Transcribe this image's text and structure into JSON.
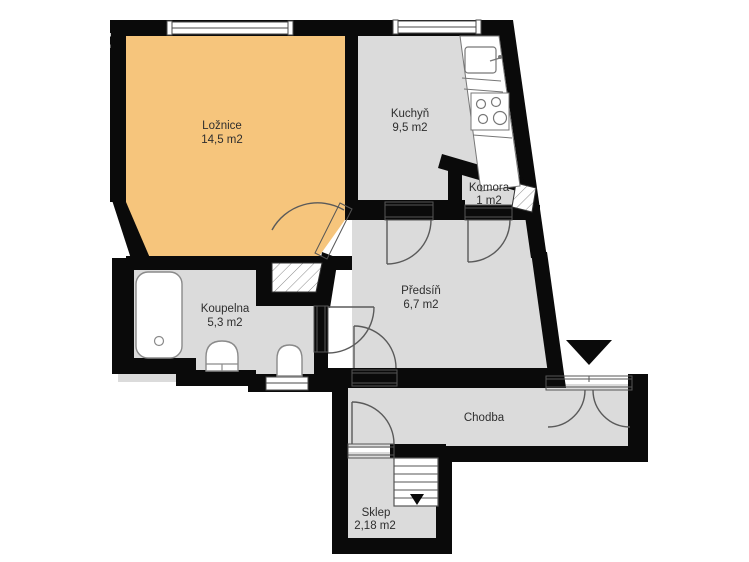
{
  "floorplan": {
    "rooms": [
      {
        "id": "loznice",
        "name": "Ložnice",
        "area": "14,5 m2"
      },
      {
        "id": "kuchyn",
        "name": "Kuchyň",
        "area": "9,5 m2"
      },
      {
        "id": "komora",
        "name": "Komora",
        "area": "1 m2"
      },
      {
        "id": "predsin",
        "name": "Předsíň",
        "area": "6,7 m2"
      },
      {
        "id": "koupelna",
        "name": "Koupelna",
        "area": "5,3 m2"
      },
      {
        "id": "chodba",
        "name": "Chodba",
        "area": ""
      },
      {
        "id": "sklep",
        "name": "Sklep",
        "area": "2,18 m2"
      }
    ],
    "colors": {
      "wall": "#0a0a0a",
      "bedroom_orange": "#F6C57C",
      "room_gray": "#DBDBDB",
      "background": "#ffffff",
      "label": "#2e2e2e"
    },
    "watermark": {
      "letters": [
        "e",
        "t"
      ],
      "color": "#ffffff"
    },
    "fixtures": [
      "bathtub",
      "washbasin",
      "toilet",
      "kitchen-sink",
      "stove",
      "kitchen-counter",
      "staircase-down",
      "entrance-arrow",
      "ventilation-shaft"
    ]
  }
}
